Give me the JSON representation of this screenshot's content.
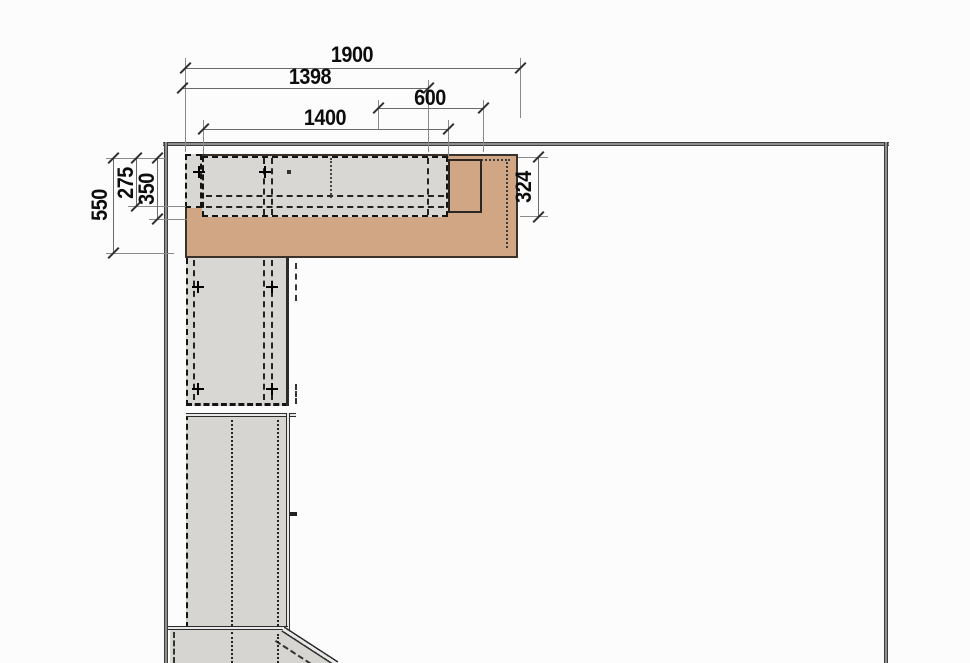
{
  "drawing": {
    "type": "kitchen-floor-plan-technical-drawing",
    "dimensions_mm": {
      "top": [
        {
          "id": "total-run",
          "label": "1900"
        },
        {
          "id": "wall-cabinet-run",
          "label": "1398"
        },
        {
          "id": "hood-width",
          "label": "600"
        },
        {
          "id": "cabinet-block-width",
          "label": "1400"
        }
      ],
      "left": [
        {
          "id": "counter-depth",
          "label": "550"
        },
        {
          "id": "left-cabinet-depth",
          "label": "275"
        },
        {
          "id": "wall-cabinet-depth",
          "label": "350"
        }
      ],
      "right": [
        {
          "id": "right-depth",
          "label": "324"
        }
      ]
    },
    "colors": {
      "countertop": "#d1a685",
      "cabinet": "#d8d7d4",
      "wall": "#474747",
      "background": "#fcfcfc",
      "dim_line": "#6a6a6a",
      "dim_text": "#0d0d0d"
    }
  }
}
